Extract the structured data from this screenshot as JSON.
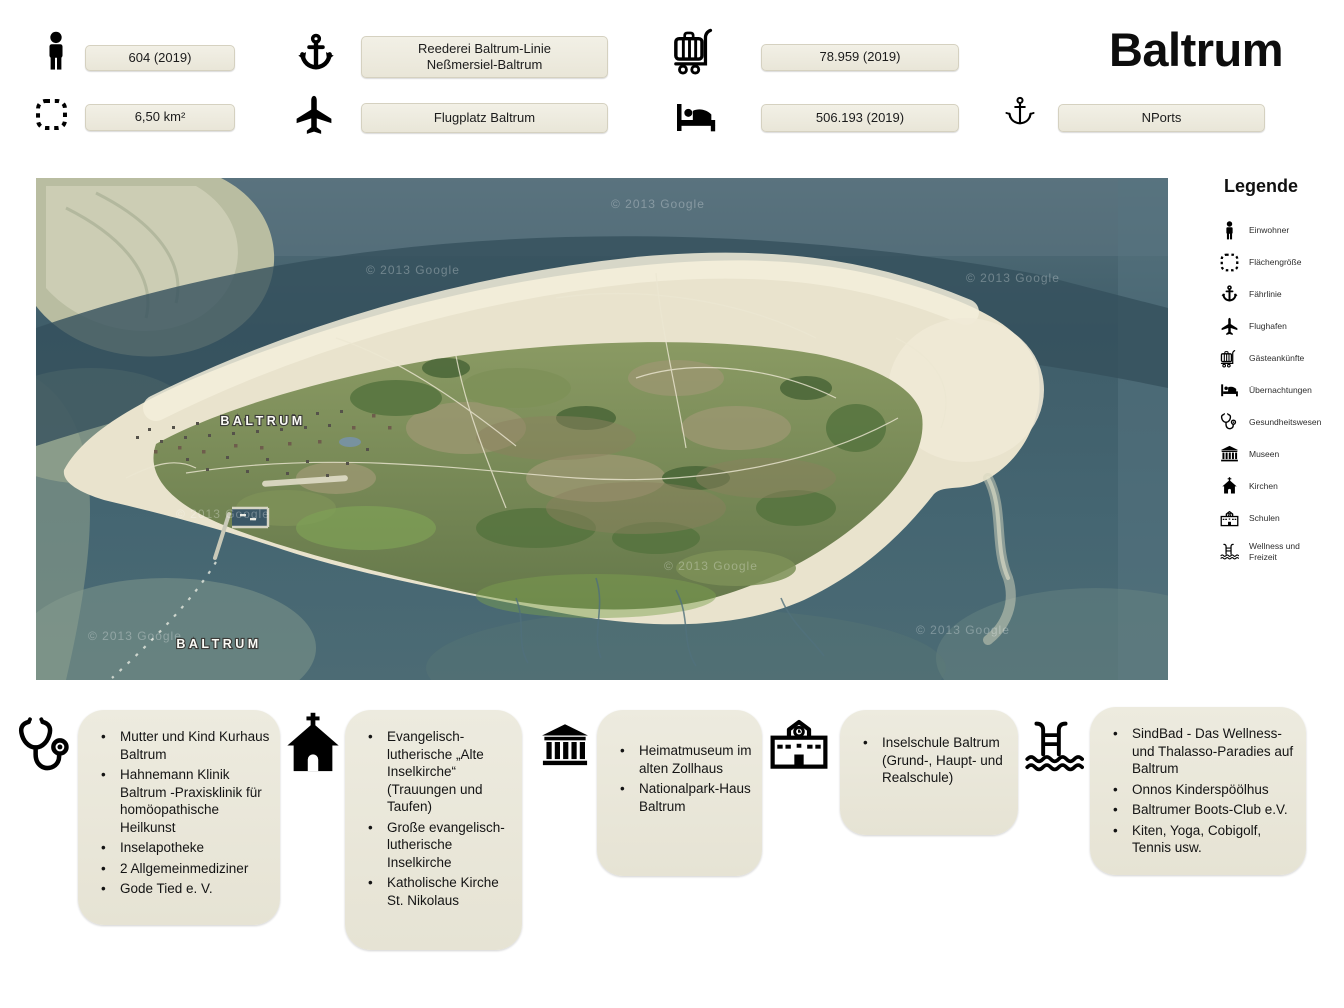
{
  "header": {
    "title": "Baltrum",
    "stats": {
      "einwohner": {
        "icon": "person-icon",
        "value": "604  (2019)"
      },
      "flaechengroesse": {
        "icon": "area-icon",
        "value": "6,50 km²"
      },
      "faehrlinie": {
        "icon": "anchor-icon",
        "line1": "Reederei Baltrum-Linie",
        "line2": "Neßmersiel-Baltrum"
      },
      "flughafen": {
        "icon": "plane-icon",
        "value": "Flugplatz Baltrum"
      },
      "gaesteankuenfte": {
        "icon": "luggage-icon",
        "value": "78.959  (2019)"
      },
      "uebernachtungen": {
        "icon": "bed-icon",
        "value": "506.193  (2019)"
      },
      "hafen": {
        "icon": "anchor-icon",
        "value": "NPorts"
      }
    }
  },
  "map": {
    "labels": {
      "town": "BALTRUM",
      "island": "BALTRUM"
    },
    "watermark": "© 2013 Google",
    "colors": {
      "water": "#44626e",
      "sand": "#e9e3cd",
      "grass": "#76884f",
      "sandbank": "#b9bda1"
    }
  },
  "legend": {
    "title": "Legende",
    "items": [
      {
        "icon": "person-icon",
        "label": "Einwohner"
      },
      {
        "icon": "area-icon",
        "label": "Flächengröße"
      },
      {
        "icon": "anchor-icon",
        "label": "Fährlinie"
      },
      {
        "icon": "plane-icon",
        "label": "Flughafen"
      },
      {
        "icon": "luggage-icon",
        "label": "Gästeankünfte"
      },
      {
        "icon": "bed-icon",
        "label": "Übernachtungen"
      },
      {
        "icon": "stethoscope-icon",
        "label": "Gesundheitswesen"
      },
      {
        "icon": "museum-icon",
        "label": "Museen"
      },
      {
        "icon": "church-icon",
        "label": "Kirchen"
      },
      {
        "icon": "school-icon",
        "label": "Schulen"
      },
      {
        "icon": "pool-icon",
        "label": "Wellness und Freizeit"
      }
    ]
  },
  "sections": {
    "gesundheit": {
      "icon": "stethoscope-icon",
      "items": [
        "Mutter und Kind Kurhaus Baltrum",
        "Hahnemann Klinik Baltrum -Praxisklinik für homöopathische Heilkunst",
        "Inselapotheke",
        "2  Allgemeinmediziner",
        "Gode Tied e. V."
      ]
    },
    "kirchen": {
      "icon": "church-icon",
      "items": [
        "Evangelisch-lutherische „Alte Inselkirche“  (Trauungen und Taufen)",
        "Große evangelisch-lutherische Inselkirche",
        "Katholische Kirche St. Nikolaus"
      ]
    },
    "museen": {
      "icon": "museum-icon",
      "items": [
        "Heimatmuseum im alten Zollhaus",
        "Nationalpark-Haus Baltrum"
      ]
    },
    "schulen": {
      "icon": "school-icon",
      "items": [
        "Inselschule Baltrum (Grund-,  Haupt- und  Realschule)"
      ]
    },
    "wellness": {
      "icon": "pool-icon",
      "items": [
        "SindBad - Das Wellness- und Thalasso-Paradies auf Baltrum",
        "Onnos Kinderspöölhus",
        "Baltrumer Boots-Club e.V.",
        "Kiten, Yoga, Cobigolf, Tennis usw."
      ]
    }
  }
}
